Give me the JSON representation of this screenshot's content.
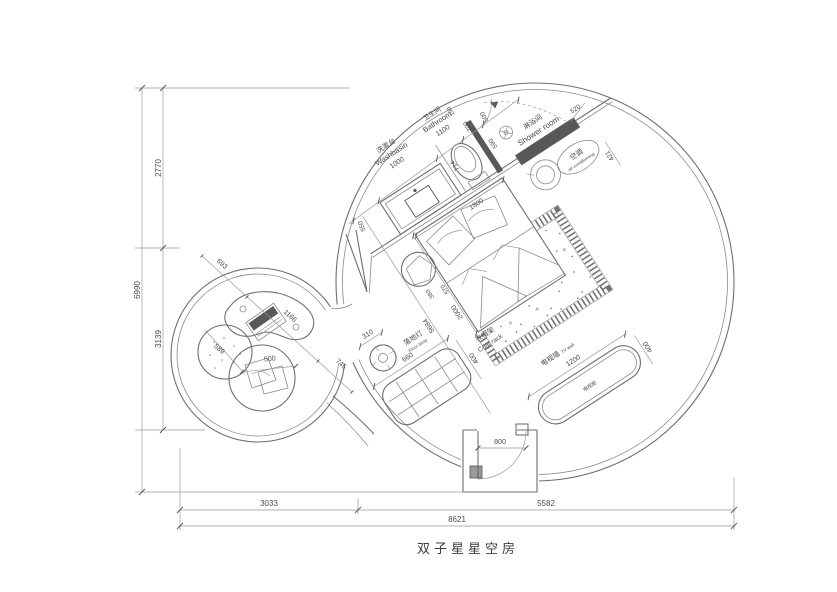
{
  "title": "双子星星空房",
  "left_dims": {
    "top": "2770",
    "bottom": "3139",
    "total": "6990"
  },
  "bottom_dims": {
    "left": "3033",
    "right": "5582",
    "total": "8621"
  },
  "bathroom_zone": {
    "washbasin_cn": "洗漱台",
    "washbasin_en": "Washbasin",
    "washbasin_w": "1000",
    "bathroom_cn": "卫生间",
    "bathroom_en": "Bathroom",
    "bathroom_w": "1100",
    "shower_cn": "淋浴间",
    "shower_en": "Shower room",
    "ac_cn": "空调",
    "ac_en": "air-conditioning",
    "d550": "550",
    "d700": "700",
    "d190": "190",
    "d500": "500",
    "d590": "590",
    "d520": "520",
    "d421": "421",
    "d714": "714"
  },
  "bed_zone": {
    "bed_w": "1800",
    "bed_l": "2000",
    "diag": "5684",
    "d570": "570",
    "d383": "383"
  },
  "lamp": {
    "cn": "落地灯",
    "en": "Floor lamp",
    "dim": "310"
  },
  "coat_rack": {
    "cn": "衣帽架",
    "en": "Coat rack",
    "w": "660",
    "d": "400"
  },
  "tv": {
    "wall_cn": "电视墙",
    "wall_en": "TV wall",
    "cabinet_cn": "电视柜",
    "w": "1200",
    "d": "400"
  },
  "entrance": {
    "door_w": "800"
  },
  "lounge": {
    "d693": "693",
    "table_w": "1166",
    "d745": "745",
    "stool_d": "589",
    "chair_d": "500"
  }
}
